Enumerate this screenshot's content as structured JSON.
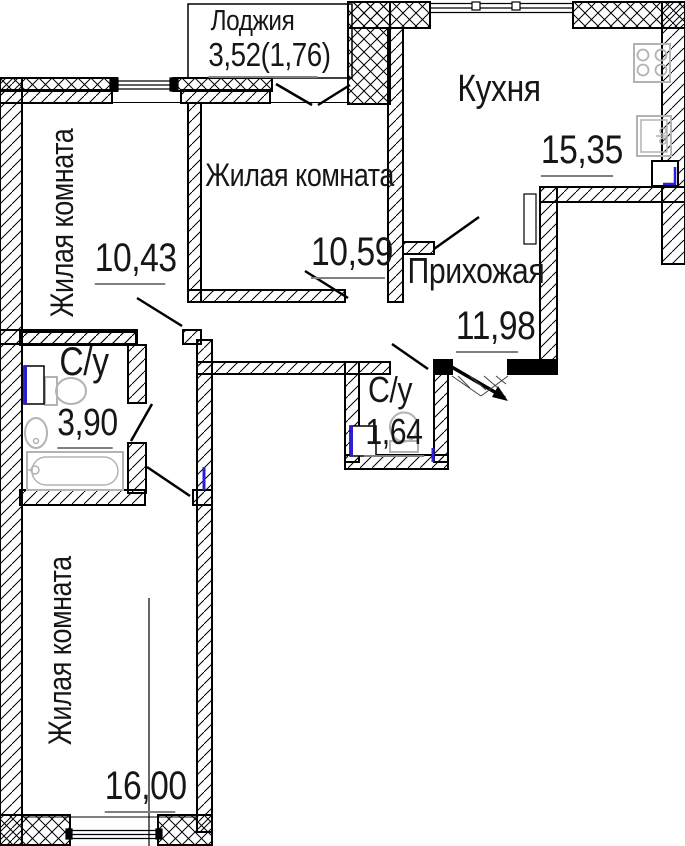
{
  "plan": {
    "rooms": [
      {
        "id": "loggia",
        "name": "Лоджия",
        "area": "3,52(1,76)"
      },
      {
        "id": "kitchen",
        "name": "Кухня",
        "area": "15,35"
      },
      {
        "id": "living-middle",
        "name": "Жилая комната",
        "area": "10,59"
      },
      {
        "id": "living-left",
        "name": "Жилая комната",
        "area": "10,43"
      },
      {
        "id": "hallway",
        "name": "Прихожая",
        "area": "11,98"
      },
      {
        "id": "bathroom-large",
        "name": "С/у",
        "area": "3,90"
      },
      {
        "id": "bathroom-small",
        "name": "С/у",
        "area": "1,64"
      },
      {
        "id": "living-bottom",
        "name": "Жилая комната",
        "area": "16,00"
      }
    ],
    "colors": {
      "wall": "#000000",
      "fixture": "#b3b3b3",
      "riser": "#2a1fd4",
      "underline": "#808080",
      "background": "#ffffff"
    },
    "icons": [
      "stove-icon",
      "kitchen-sink-icon",
      "toilet-icon",
      "washbasin-icon",
      "bathtub-icon",
      "entry-arrow-icon"
    ]
  }
}
